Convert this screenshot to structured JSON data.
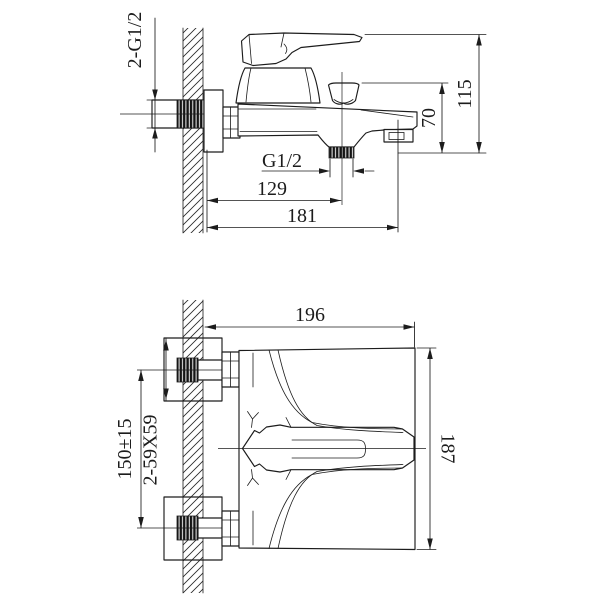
{
  "drawing": {
    "colors": {
      "line": "#1c1c1c",
      "background": "#ffffff",
      "thread_fill": "#141414"
    }
  },
  "views": {
    "side": {
      "dims": {
        "inlet_threads": "2-G1/2",
        "outlet_thread": "G1/2",
        "outlet_offset": "129",
        "total_depth": "181",
        "spout_drop": "70",
        "total_height": "115"
      }
    },
    "plan": {
      "dims": {
        "total_width": "196",
        "total_depth": "187",
        "inlet_spacing": "150±15",
        "escutcheon": "2-59X59"
      }
    }
  }
}
